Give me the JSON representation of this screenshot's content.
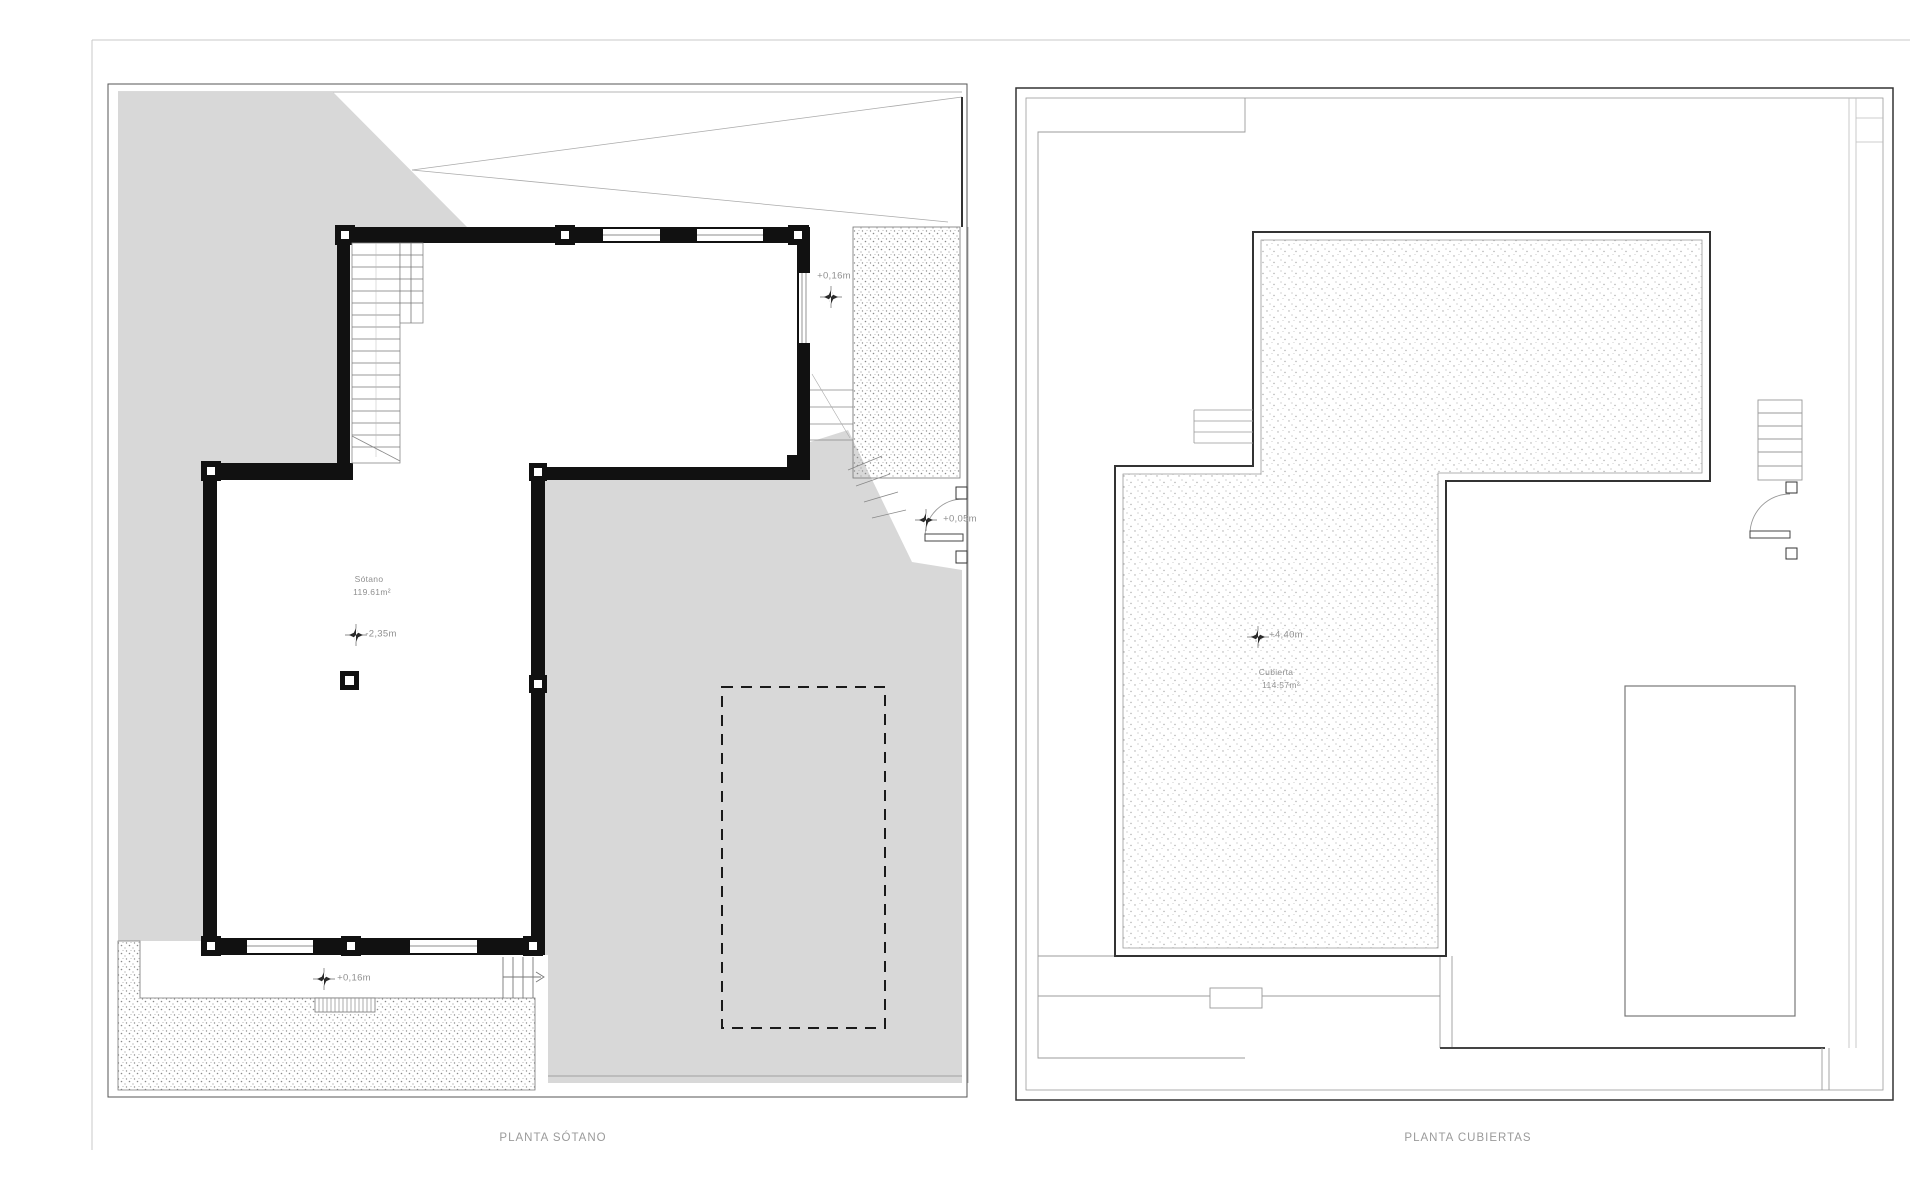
{
  "sheet": {
    "background": "#ffffff"
  },
  "colors": {
    "terrain_gray": "#d8d8d8",
    "wall_black": "#111111",
    "medium_line": "#444444",
    "thin_line": "#999999",
    "text_gray": "#8f8f8f"
  },
  "plans": {
    "sotano": {
      "title": "PLANTA SÓTANO",
      "room_label": "Sótano",
      "room_area": "119.61m²",
      "levels": {
        "terrace_top": "+0,16m",
        "floor": "-2,35m",
        "landing": "+0,05m",
        "terrace_bottom": "+0,16m"
      }
    },
    "cubiertas": {
      "title": "PLANTA CUBIERTAS",
      "room_label": "Cubierta",
      "room_area": "114.57m²",
      "levels": {
        "roof": "+4,40m"
      }
    }
  }
}
